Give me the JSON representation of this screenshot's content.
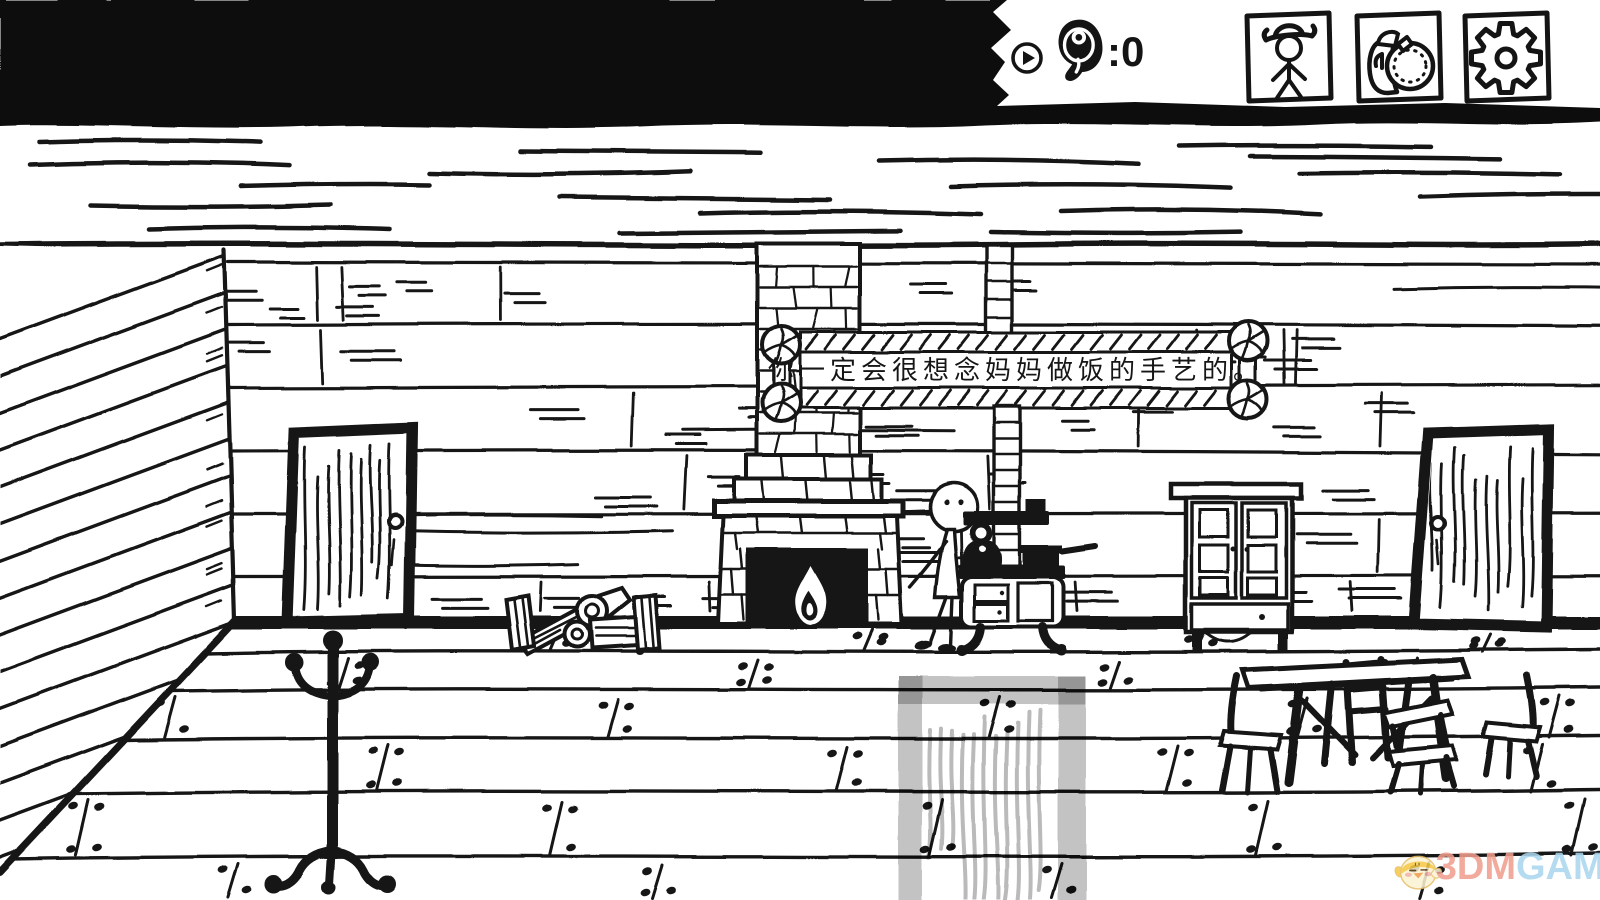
{
  "hud": {
    "meat": {
      "icon": "meat-icon",
      "display": ":0"
    },
    "play_icon": "play-icon",
    "buttons": [
      {
        "id": "character",
        "icon": "cowboy-hat-stickfigure-icon"
      },
      {
        "id": "inventory",
        "icon": "canteen-backpack-icon"
      },
      {
        "id": "settings",
        "icon": "gear-icon"
      }
    ]
  },
  "sign": {
    "text": "你一定会很想念妈妈做饭的手艺的。"
  },
  "watermark": {
    "brand_left": "3DM",
    "brand_right": "GAME",
    "color_left": "#ef9e8e",
    "color_right": "#a9d6ee"
  },
  "colors": {
    "ink": "#141414",
    "paper": "#ffffff",
    "rug_gray": "#c4c4c4"
  }
}
